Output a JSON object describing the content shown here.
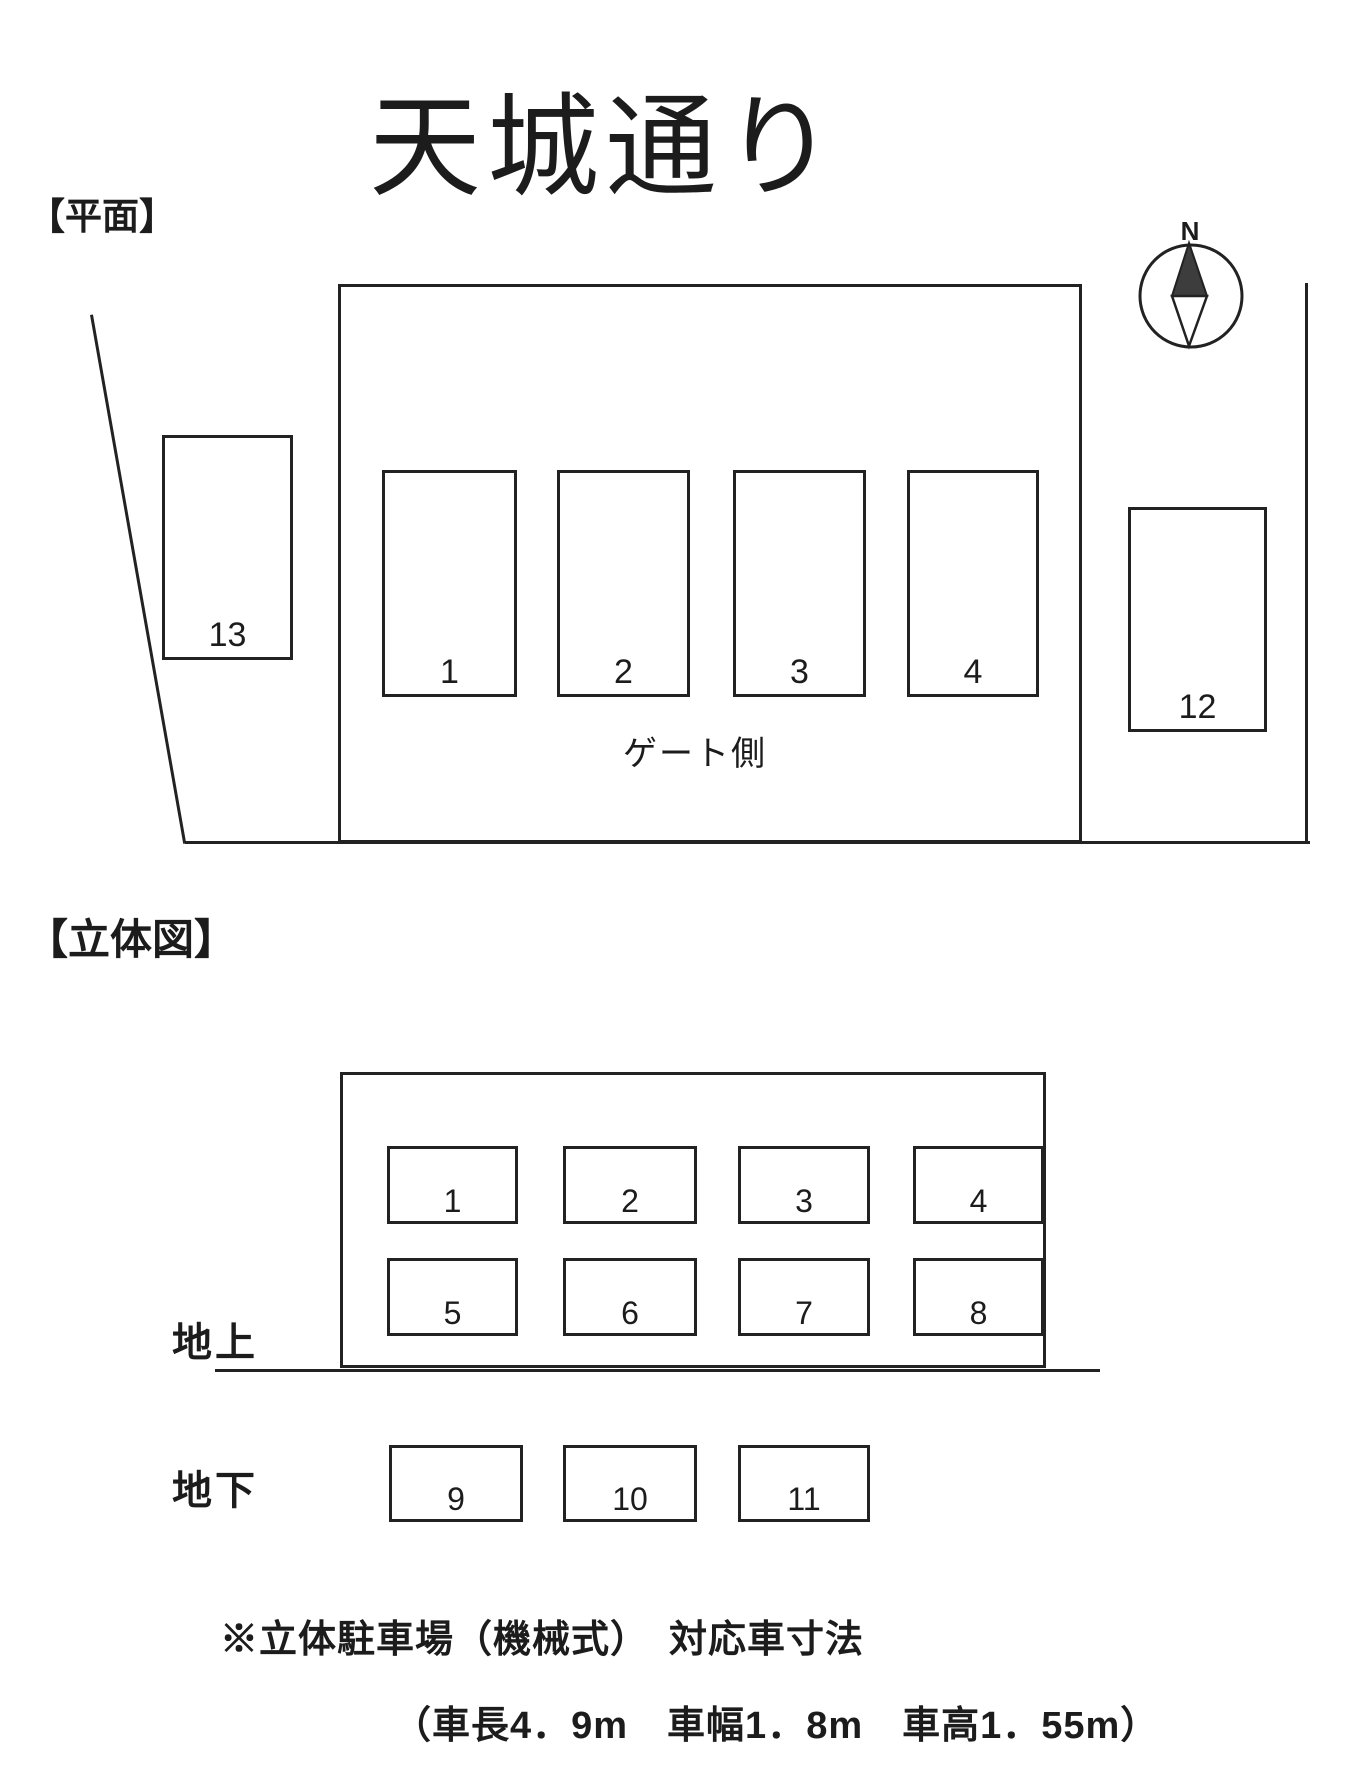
{
  "title": "天城通り",
  "plan": {
    "section_label": "【平面】",
    "gate_label": "ゲート側",
    "compass_north": "N",
    "spaces": {
      "s1": "1",
      "s2": "2",
      "s3": "3",
      "s4": "4",
      "s12": "12",
      "s13": "13"
    }
  },
  "elevation": {
    "section_label": "【立体図】",
    "ground_label": "地上",
    "underground_label": "地下",
    "above": [
      "1",
      "2",
      "3",
      "4",
      "5",
      "6",
      "7",
      "8"
    ],
    "underground": [
      "9",
      "10",
      "11"
    ]
  },
  "notes": {
    "line1": "※立体駐車場（機械式）　対応車寸法",
    "line2": "（車長4．9m　車幅1．8m　車高1．55m）"
  }
}
